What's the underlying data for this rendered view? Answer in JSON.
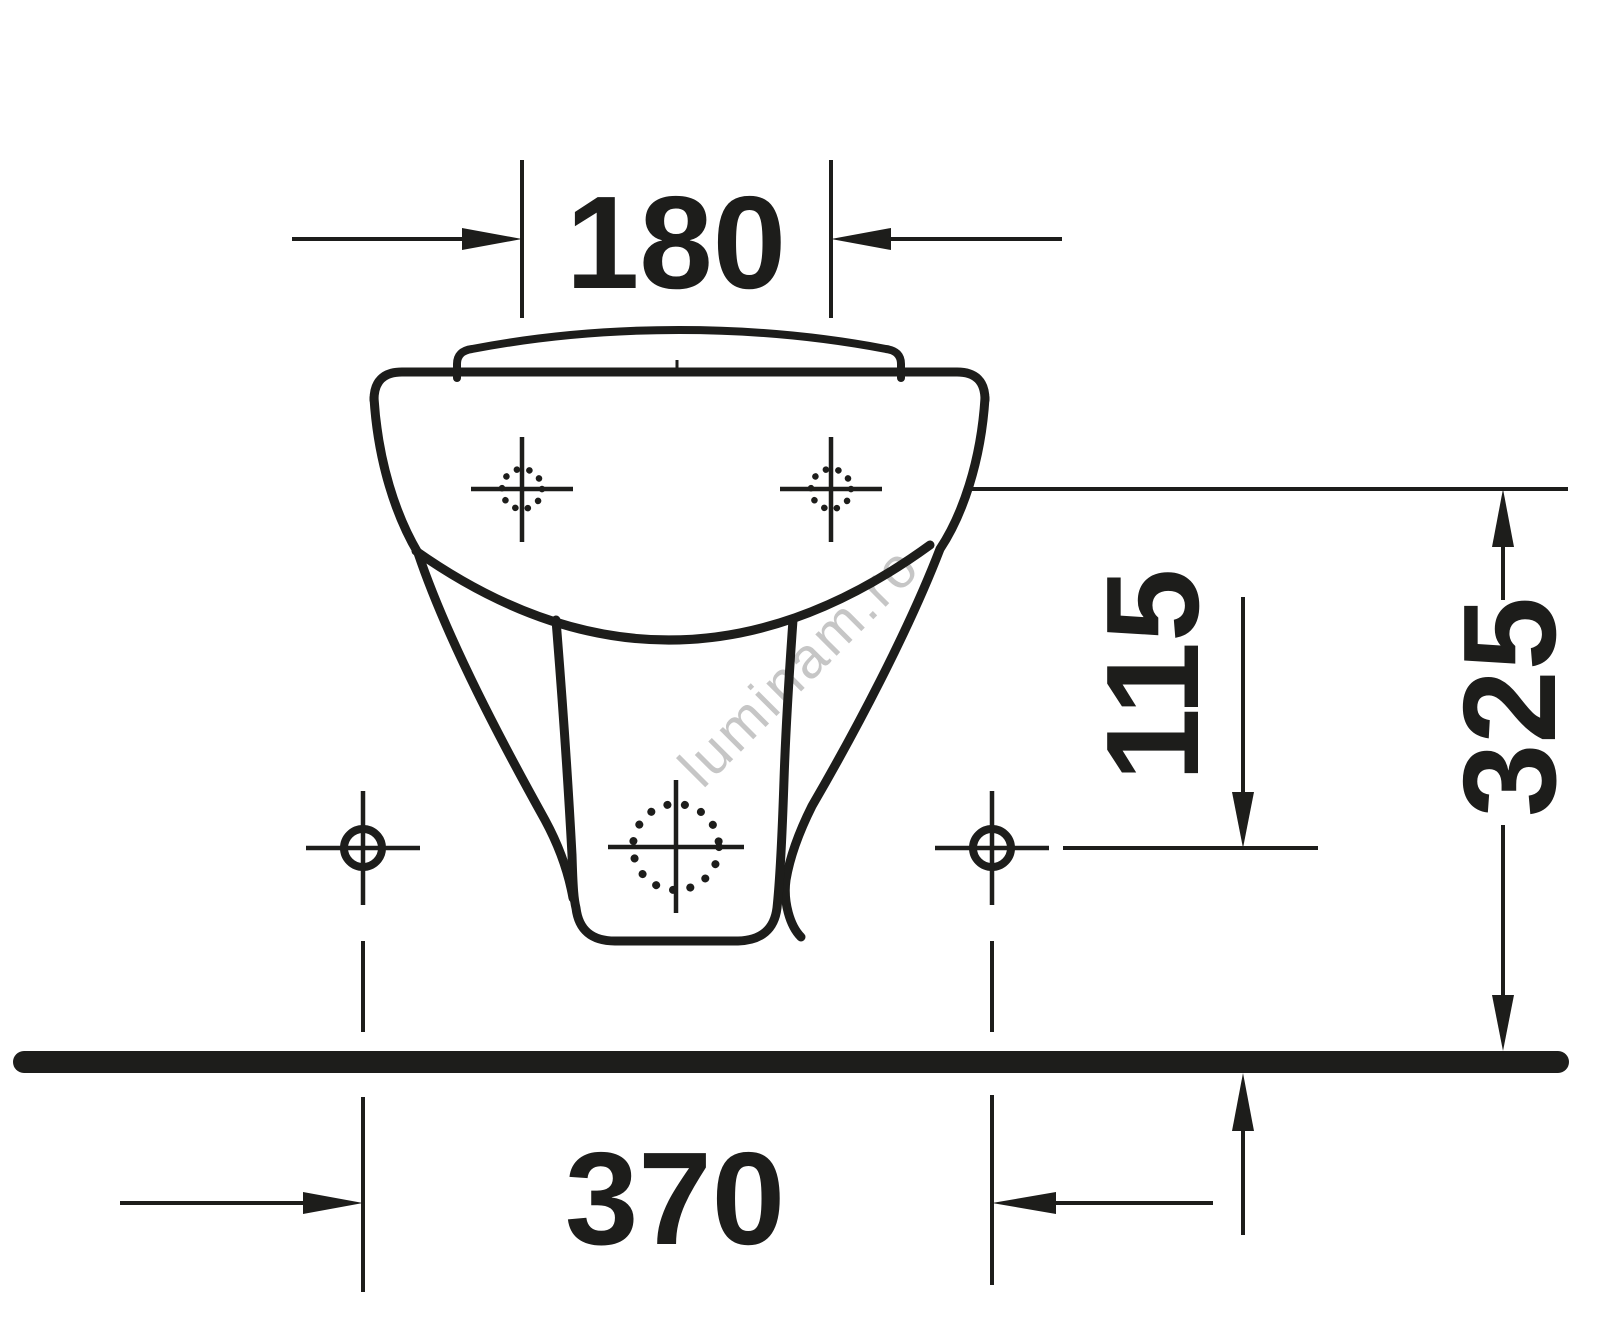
{
  "drawing": {
    "type": "technical-dimension-drawing",
    "subject": "wall-hung bidet front view",
    "background_color": "#ffffff",
    "line_color": "#1d1d1b",
    "watermark": {
      "text": "luminam.ro",
      "color": "#c6c6c6"
    },
    "dimensions": {
      "tap_hole_spacing": "180",
      "side_hole_height_above_floor": "115",
      "upper_hole_height_above_floor": "325",
      "side_hole_spacing": "370"
    }
  }
}
